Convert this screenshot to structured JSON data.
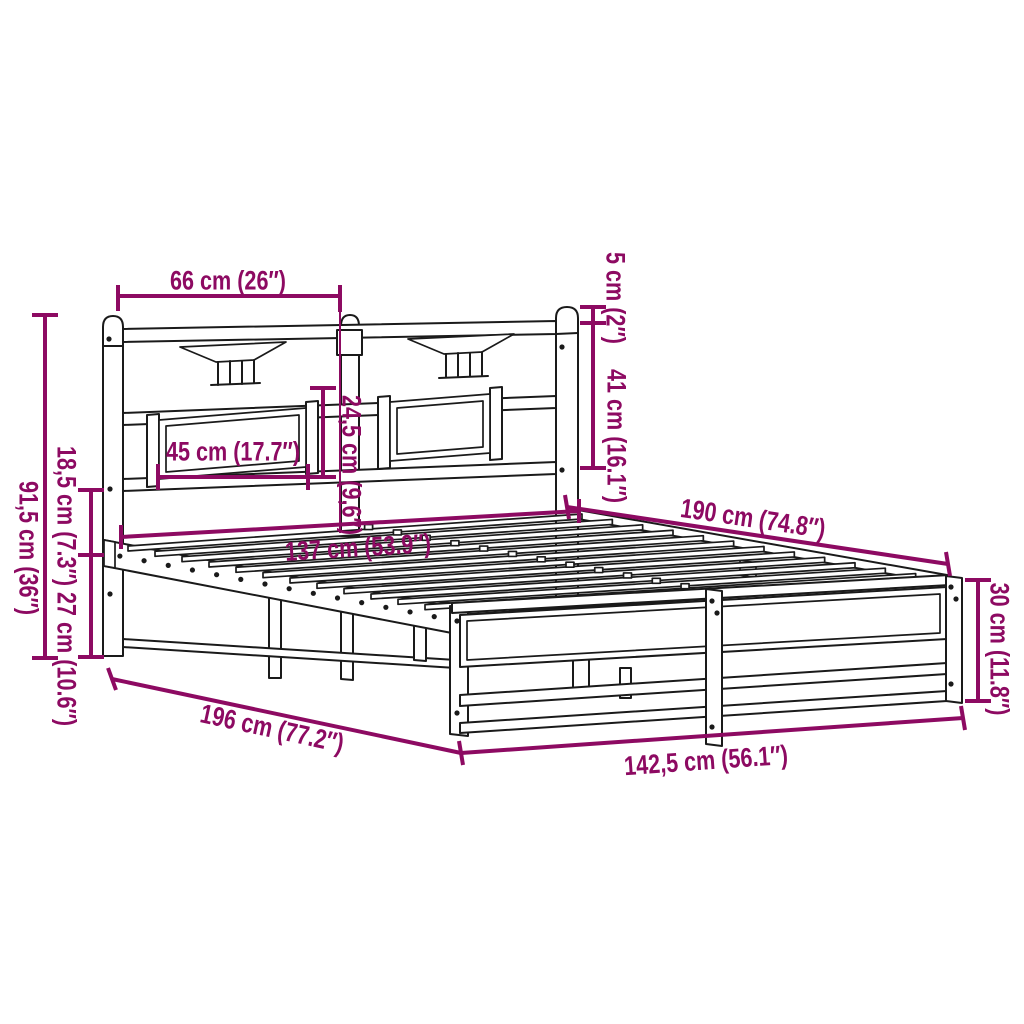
{
  "diagram_type": "product-dimension-line-drawing",
  "subject": "metal bed frame with headboard",
  "colors": {
    "accent": "#8d0a62",
    "line": "#1a1a1a",
    "background": "#ffffff"
  },
  "dims": {
    "headboard_section_width": {
      "label": "66 cm (26″)",
      "cm": "66",
      "in": "26"
    },
    "post_cap_above_rail": {
      "label": "5 cm (2″)",
      "cm": "5",
      "in": "2"
    },
    "headboard_upper_height": {
      "label": "41 cm (16.1″)",
      "cm": "41",
      "in": "16.1"
    },
    "panel_height": {
      "label": "24,5 cm (9,6″)",
      "cm": "24,5",
      "in": "9,6"
    },
    "panel_width": {
      "label": "45 cm (17.7″)",
      "cm": "45",
      "in": "17.7"
    },
    "inner_width": {
      "label": "137 cm (53.9″)",
      "cm": "137",
      "in": "53.9"
    },
    "bed_length": {
      "label": "190 cm (74.8″)",
      "cm": "190",
      "in": "74.8"
    },
    "foot_end_height": {
      "label": "30 cm (11.8″)",
      "cm": "30",
      "in": "11.8"
    },
    "outer_width": {
      "label": "142,5 cm (56.1″)",
      "cm": "142,5",
      "in": "56.1"
    },
    "total_length": {
      "label": "196 cm (77.2″)",
      "cm": "196",
      "in": "77.2"
    },
    "headboard_height": {
      "label": "91,5 cm (36″)",
      "cm": "91,5",
      "in": "36"
    },
    "rail_gap_height": {
      "label": "18,5 cm (7.3″)",
      "cm": "18,5",
      "in": "7.3"
    },
    "under_bed_clearance": {
      "label": "27 cm (10.6″)",
      "cm": "27",
      "in": "10.6"
    }
  }
}
